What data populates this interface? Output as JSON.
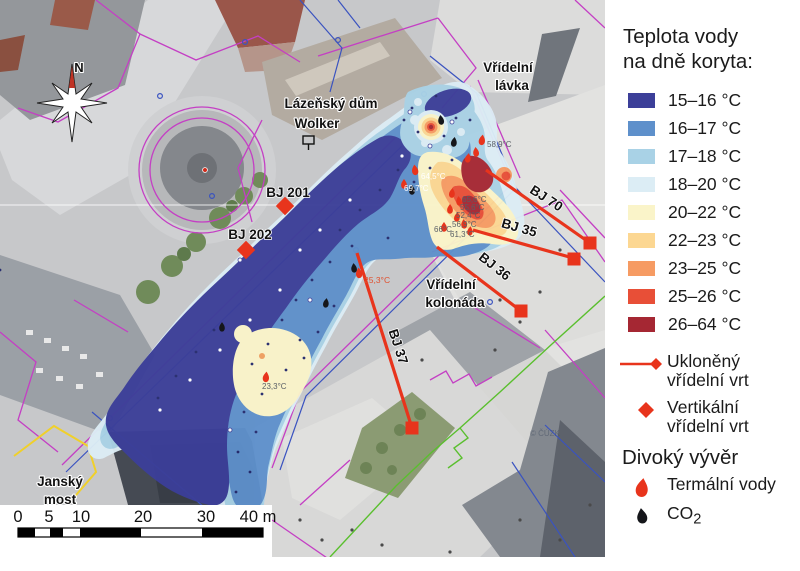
{
  "legend": {
    "title_line1": "Teplota vody",
    "title_line2": "na dně koryta:",
    "items": [
      {
        "range": "15–16 °C",
        "color": "#3c3f99"
      },
      {
        "range": "16–17 °C",
        "color": "#5e90cb"
      },
      {
        "range": "17–18 °C",
        "color": "#a9d2e6"
      },
      {
        "range": "18–20 °C",
        "color": "#dcedf5"
      },
      {
        "range": "20–22 °C",
        "color": "#faf4c9"
      },
      {
        "range": "22–23 °C",
        "color": "#fcd792"
      },
      {
        "range": "23–25 °C",
        "color": "#f69b63"
      },
      {
        "range": "25–26 °C",
        "color": "#e84f37"
      },
      {
        "range": "26–64 °C",
        "color": "#a52733"
      }
    ],
    "inclined_label_1": "Ukloněný",
    "inclined_label_2": "vřídelní vrt",
    "vertical_label_1": "Vertikální",
    "vertical_label_2": "vřídelní vrt",
    "wild_heading": "Divoký vývěr",
    "thermal_label": "Termální vody",
    "co2_label": "CO",
    "co2_sub": "2",
    "accent_red": "#e8341c"
  },
  "map": {
    "compass_label": "N",
    "attribution": "© ČÚZK",
    "labels": {
      "vridelni_lavka_1": "Vřídelní",
      "vridelni_lavka_2": "lávka",
      "lazensky_dum_1": "Lázeňský dům",
      "lazensky_dum_2": "Wolker",
      "vridelni_kolonada_1": "Vřídelní",
      "vridelni_kolonada_2": "kolonáda",
      "jansky_most_1": "Janský",
      "jansky_most_2": "most",
      "bj201": "BJ 201",
      "bj202": "BJ 202",
      "bj70": "BJ 70",
      "bj35": "BJ 35",
      "bj36": "BJ 36",
      "bj37": "BJ 37"
    },
    "temperatures": {
      "t1": "58,9°C",
      "t2": "64,5°C",
      "t3": "69,7°C",
      "t4": "65,6°C",
      "t5": "55,6°C",
      "t6": "52,4°C",
      "t7": "56,9°C",
      "t8": "66°C",
      "t9": "61,3°C",
      "t10": "25,3°C",
      "t11": "23,3°C"
    },
    "scalebar": {
      "t0": "0",
      "t5": "5",
      "t10": "10",
      "t20": "20",
      "t30": "30",
      "t40": "40 m"
    }
  }
}
